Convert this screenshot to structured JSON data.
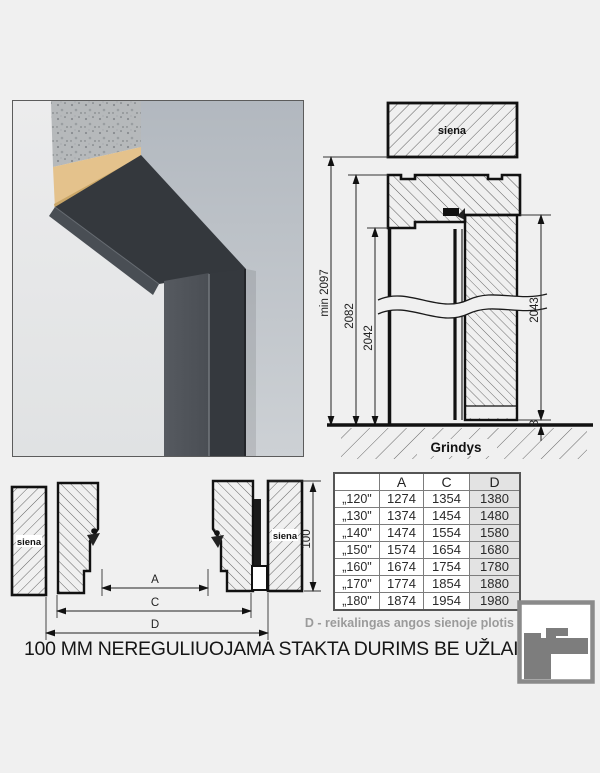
{
  "title": "100 MM NEREGULIUOJAMA STAKTA DURIMS BE UŽLAIDOS",
  "note_d": "D - reikalingas angos sienoje plotis",
  "elevation": {
    "wall_label": "siena",
    "floor_label": "Grindys",
    "dims": {
      "min_total": "min 2097",
      "frame_outer": "2082",
      "opening": "2042",
      "door": "2043",
      "floor_gap": "8"
    }
  },
  "plan": {
    "wall_label_left": "siena",
    "wall_label_right": "siena",
    "dims": {
      "a": "A",
      "c": "C",
      "d": "D",
      "frame_depth": "100"
    }
  },
  "table": {
    "headers": [
      "",
      "A",
      "C",
      "D"
    ],
    "rows": [
      [
        "„120\"",
        "1274",
        "1354",
        "1380"
      ],
      [
        "„130\"",
        "1374",
        "1454",
        "1480"
      ],
      [
        "„140\"",
        "1474",
        "1554",
        "1580"
      ],
      [
        "„150\"",
        "1574",
        "1654",
        "1680"
      ],
      [
        "„160\"",
        "1674",
        "1754",
        "1780"
      ],
      [
        "„170\"",
        "1774",
        "1854",
        "1880"
      ],
      [
        "„180\"",
        "1874",
        "1954",
        "1980"
      ]
    ]
  },
  "colors": {
    "background": "#f0f0f0",
    "frame_dark": "#34383d",
    "frame_mid": "#4b5056",
    "wall_blue_gray": "#b7bdc3",
    "board_tan": "#e4c28c",
    "concrete": "#b6b9bb",
    "table_shade": "#e3e3e3",
    "note_gray": "#9b9b9b",
    "logo_gray": "#7d7d7d",
    "line_black": "#111111"
  }
}
